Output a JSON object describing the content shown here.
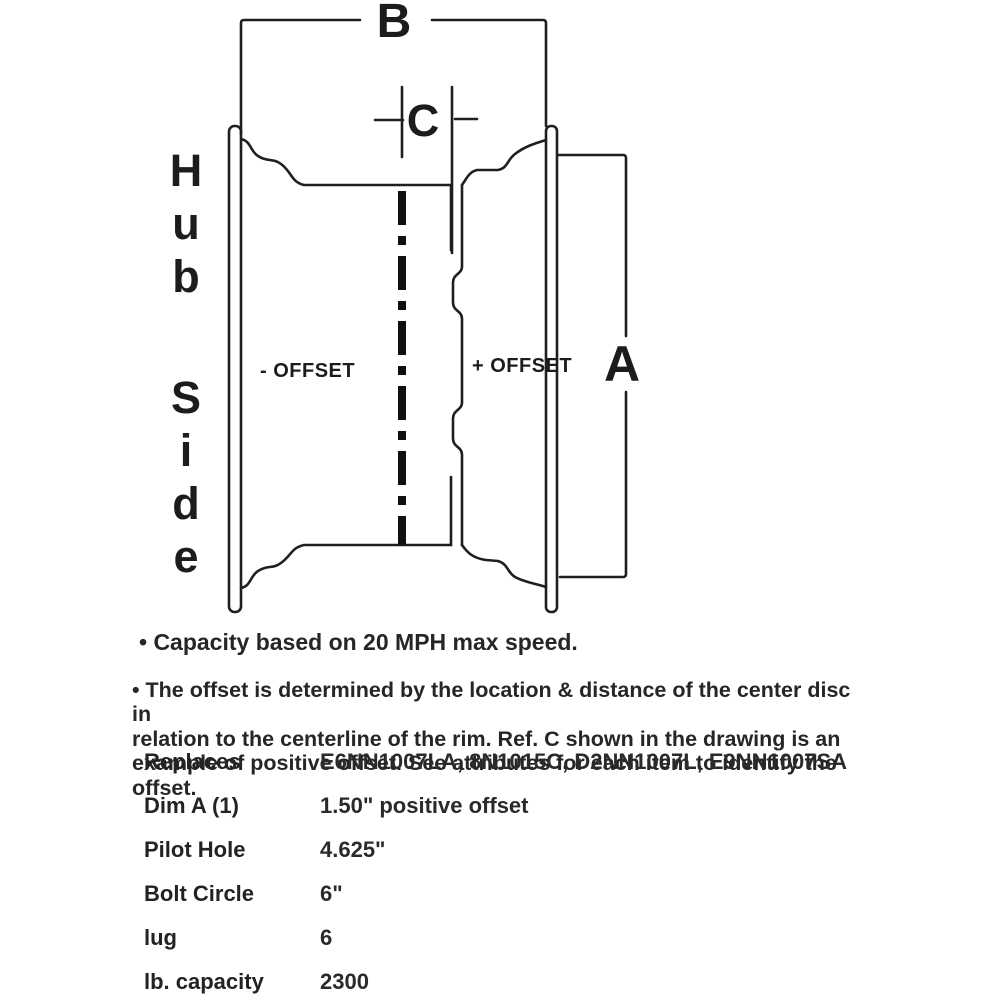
{
  "diagram": {
    "dim_b_label": "B",
    "dim_c_label": "C",
    "dim_a_label": "A",
    "hub_side_word1": "Hub",
    "hub_side_word2": "Side",
    "negative_offset_label": "- OFFSET",
    "positive_offset_label": "+ OFFSET",
    "line_color": "#1f1f1f"
  },
  "notes": {
    "capacity_note": "•  Capacity based on 20 MPH max speed.",
    "offset_note_lines": {
      "line1": "•  The offset is determined by the location & distance of the center disc in",
      "line2": "relation to the centerline of the rim. Ref. C shown in the drawing is an",
      "line3": "example of positive offset. See attributes for each item to identify the offset."
    }
  },
  "specs": {
    "rows": [
      {
        "label": "Replaces",
        "value": "E6NN1007LA, 8N1015C, D2NN1007L, E9NN1007SA"
      },
      {
        "label": "Dim A (1)",
        "value": "1.50\" positive offset"
      },
      {
        "label": "Pilot Hole",
        "value": "4.625\""
      },
      {
        "label": "Bolt Circle",
        "value": "6\""
      },
      {
        "label": "lug",
        "value": "6"
      },
      {
        "label": "lb. capacity",
        "value": "2300"
      }
    ]
  }
}
